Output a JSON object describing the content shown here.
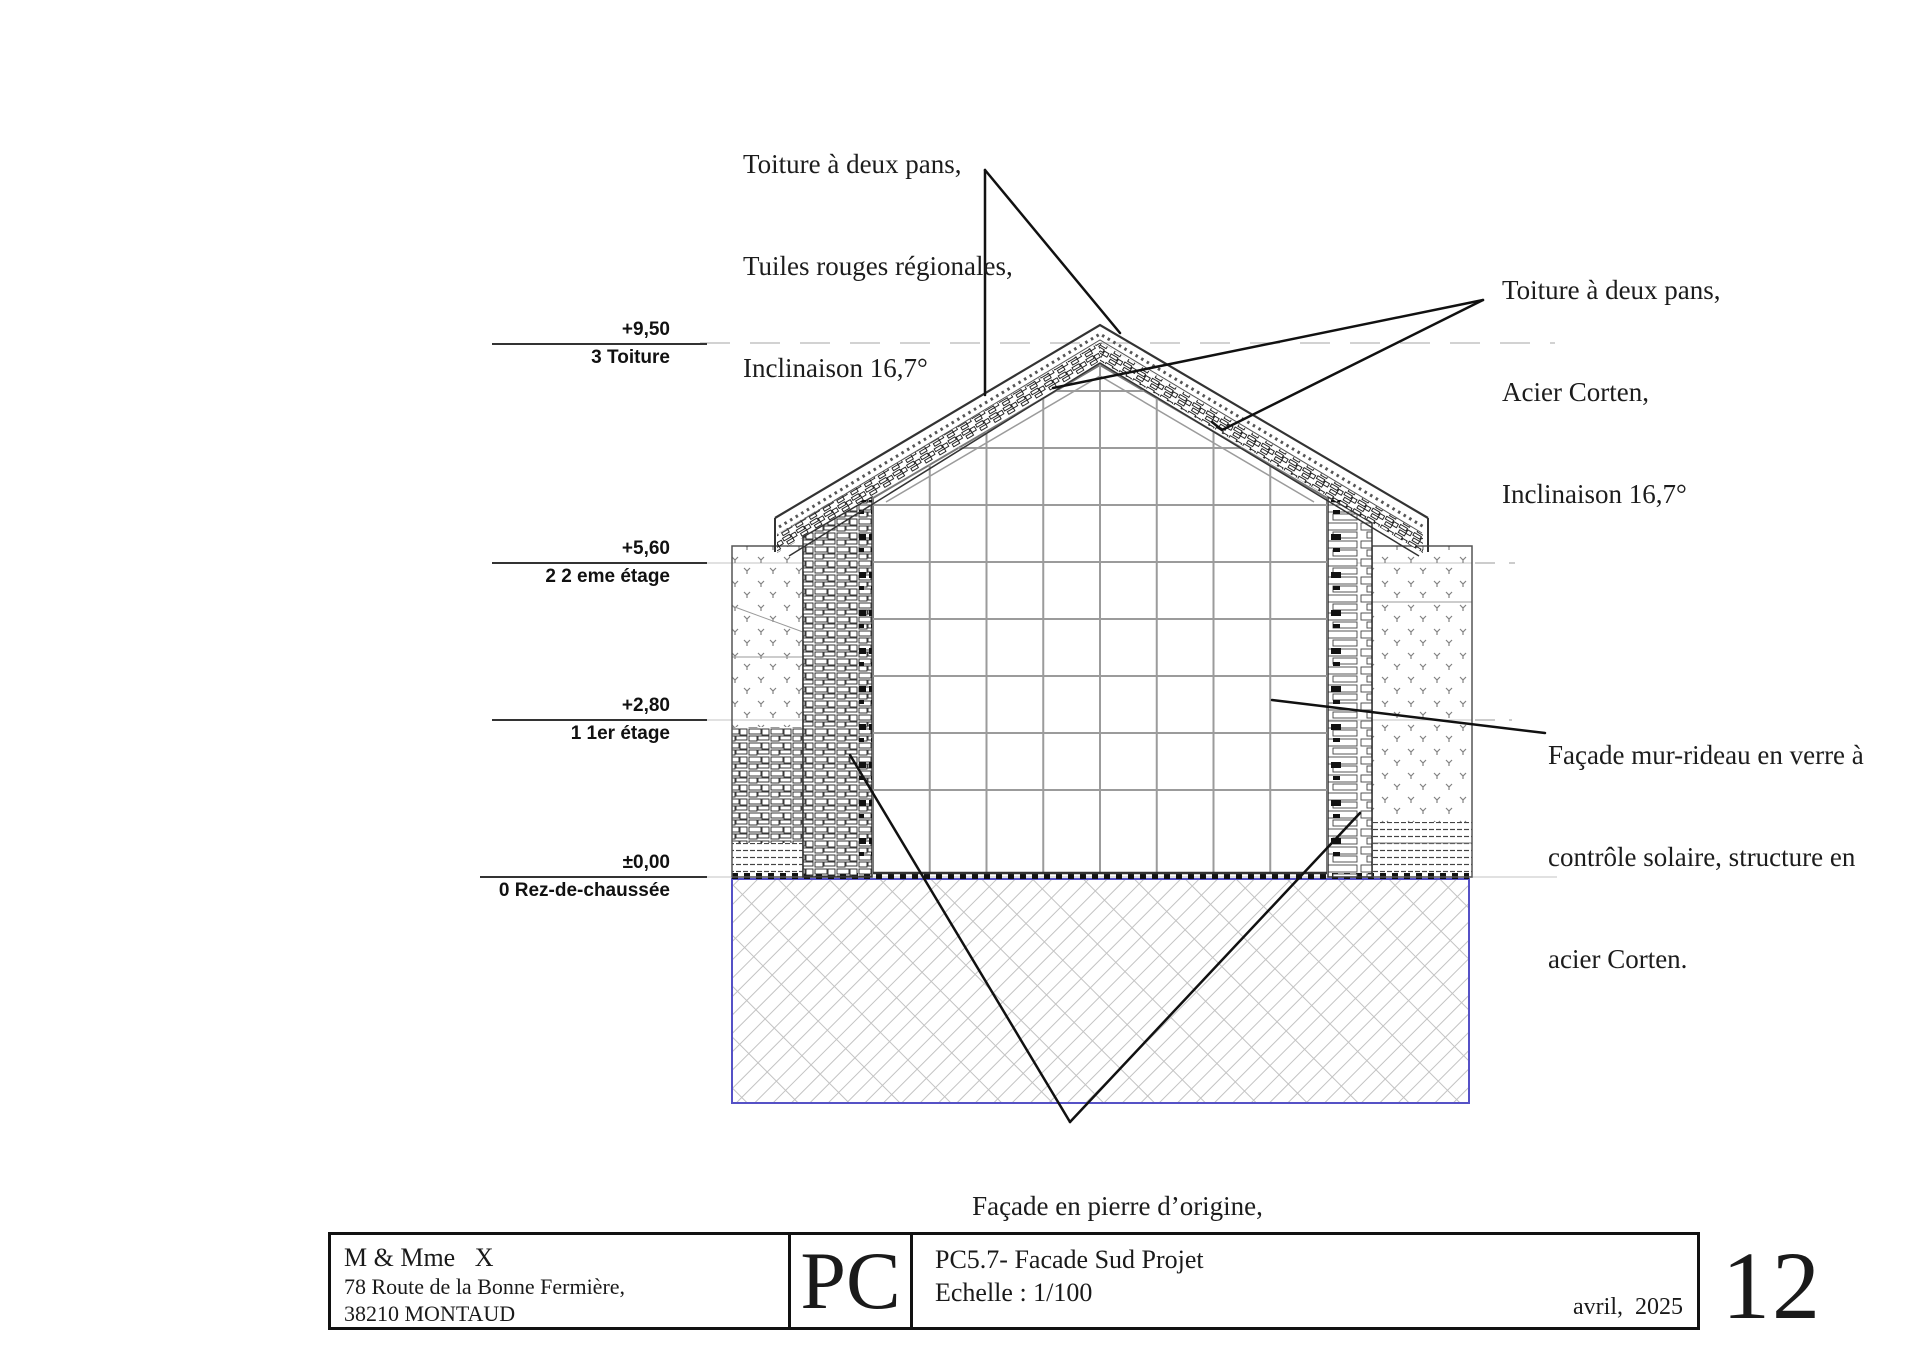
{
  "annotations": {
    "roof_tiles": {
      "lines": [
        "Toiture à deux pans,",
        "Tuiles rouges régionales,",
        "Inclinaison 16,7°"
      ]
    },
    "roof_corten": {
      "lines": [
        "Toiture à deux pans,",
        "Acier Corten,",
        "Inclinaison 16,7°"
      ]
    },
    "curtain_wall": {
      "lines": [
        "Façade mur-rideau en verre à",
        "contrôle solaire, structure en",
        "acier Corten."
      ]
    },
    "stone_facade": {
      "lines": [
        "Façade en pierre d’origine,",
        "Restaurée à l’identique."
      ]
    }
  },
  "levels": [
    {
      "elevation": "+9,50",
      "name": "3 Toiture"
    },
    {
      "elevation": "+5,60",
      "name": "2 2 eme étage"
    },
    {
      "elevation": "+2,80",
      "name": "1 1er étage"
    },
    {
      "elevation": "±0,00",
      "name": "0 Rez-de-chaussée"
    }
  ],
  "title_block": {
    "client": {
      "name": "M & Mme   X",
      "address_line1": "78 Route de la Bonne Fermière,",
      "address_line2": "38210 MONTAUD"
    },
    "logo": "PC",
    "drawing": {
      "reference": "PC5.7- Facade Sud Projet",
      "scale": "Echelle : 1/100"
    },
    "date": "avril,  2025",
    "page_number": "12"
  },
  "colors": {
    "ground_border": "#5551c6",
    "leader_line": "#111111",
    "hatch_gray": "#c3c3c3"
  }
}
